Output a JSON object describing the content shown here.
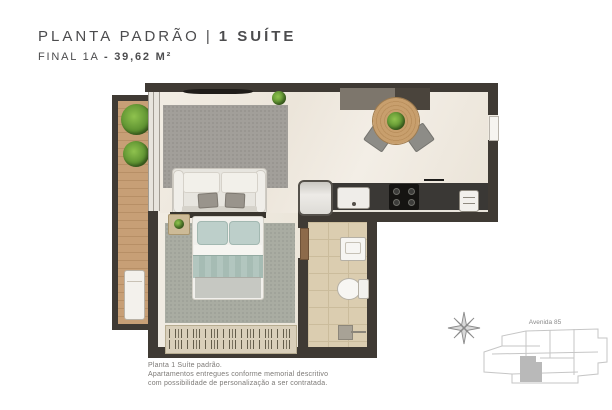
{
  "header": {
    "title_main": "PLANTA PADRÃO",
    "title_sep": "|",
    "title_bold": "1 SUÍTE",
    "subtitle_main": "FINAL 1A",
    "subtitle_sep": "-",
    "subtitle_bold": "39,62 M²"
  },
  "footer": {
    "line1": "Planta 1 Suíte padrão.",
    "line2": "Apartamentos entregues conforme memorial descritivo",
    "line3": "com possibilidade de personalização a ser contratada."
  },
  "keyplan": {
    "street_label": "Avenida 85"
  },
  "colors": {
    "wall": "#3f3a34",
    "floor_marble": "#f0ebe2",
    "balcony_wood": "#c79f76",
    "bathroom_tile": "#dbcdb0",
    "living_rug": "#a29f9a",
    "bedroom_rug": "#a9aca2",
    "bed_textile": "#bdcfca",
    "table_wood": "#c89f6d",
    "plant_green": "#6faa35",
    "counter_dark": "#3a3835",
    "title_text": "#4c4c4e",
    "footer_text": "#7c7976"
  }
}
